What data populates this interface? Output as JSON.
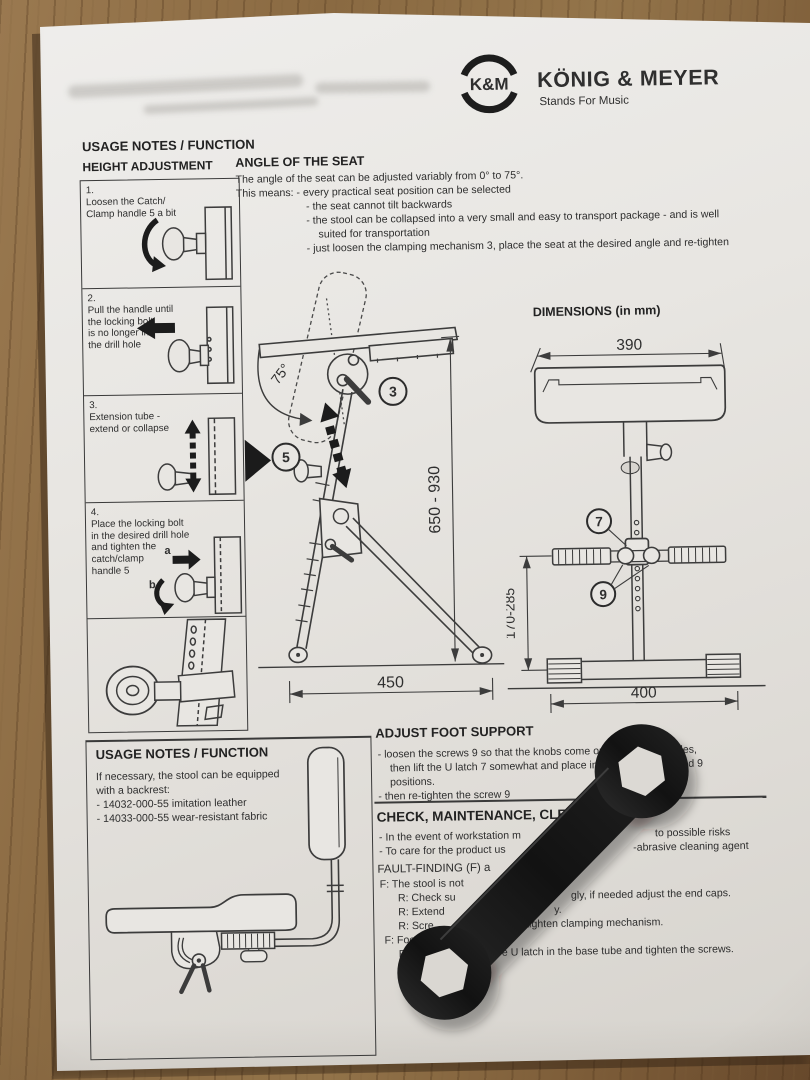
{
  "logo": {
    "monogram": "K&M",
    "brand": "KÖNIG & MEYER",
    "tagline": "Stands For Music"
  },
  "usage_top": {
    "title": "USAGE NOTES / FUNCTION",
    "subtitle": "HEIGHT ADJUSTMENT",
    "steps": {
      "s1": {
        "num": "1.",
        "l1": "Loosen the Catch/",
        "l2": "Clamp handle 5 a bit"
      },
      "s2": {
        "num": "2.",
        "l1": "Pull the handle until",
        "l2": "the locking bolt",
        "l3": "is no longer in",
        "l4": "the drill hole"
      },
      "s3": {
        "num": "3.",
        "l1": "Extension tube -",
        "l2": "extend or collapse"
      },
      "s4": {
        "num": "4.",
        "l1": "Place the locking bolt",
        "l2": "in the desired drill hole",
        "l3": "and tighten the",
        "l4": "catch/clamp",
        "l5": "handle 5"
      }
    },
    "arrow_a": "a",
    "arrow_b": "b"
  },
  "angle": {
    "title": "ANGLE OF THE SEAT",
    "l1": "The angle of the seat can be adjusted variably from 0° to 75°.",
    "l2": "This means: - every practical seat position can be selected",
    "l3": "- the seat cannot tilt backwards",
    "l4": "- the stool can be collapsed into a very small and easy to transport package - and is well",
    "l5": "suited for transportation",
    "l6": "- just loosen the clamping mechanism 3, place the seat at the desired angle and re-tighten"
  },
  "dims": {
    "title": "DIMENSIONS (in mm)",
    "seat_width": "390",
    "height_range": "650 - 930",
    "support_height": "170-285",
    "seat_depth": "450",
    "base_width": "400",
    "seat_angle": "75°",
    "c3": "3",
    "c5": "5",
    "c7": "7",
    "c9": "9"
  },
  "backrest": {
    "title": "USAGE NOTES / FUNCTION",
    "l1": "If necessary, the stool can be equipped",
    "l2": "with a backrest:",
    "l3": "- 14032-000-55 imitation leather",
    "l4": "- 14033-000-55 wear-resistant fabric"
  },
  "foot": {
    "title": "ADJUST FOOT SUPPORT",
    "l1a": "- loosen the screws 9 so that the knobs come out",
    "l1b": "holes,",
    "l2a": "then lift the U latch 7 somewhat and place in o",
    "l2b": "red 9",
    "l3": "positions.",
    "l4": "- then re-tighten the screw 9"
  },
  "check": {
    "title": "CHECK, MAINTENANCE, CLE",
    "l1a": "- In the event of workstation m",
    "l1b": "to possible risks",
    "l2a": "- To care for the product us",
    "l2b": "-abrasive cleaning agent"
  },
  "fault": {
    "title": "FAULT-FINDING (F) a",
    "f1": "F: The stool is not",
    "r1a": "R: Check su",
    "r1b": "gly, if needed adjust the end caps.",
    "r2a": "R: Extend",
    "r2b": "y.",
    "r3a": "R: Scre",
    "r3b": "e, tighten clamping mechanism.",
    "f2a": "F: Foot",
    "f2b": "pport si",
    "r4a": "R:",
    "r4b": "ce Knobs",
    "r4c": "e U latch in the base tube and tighten the screws."
  }
}
